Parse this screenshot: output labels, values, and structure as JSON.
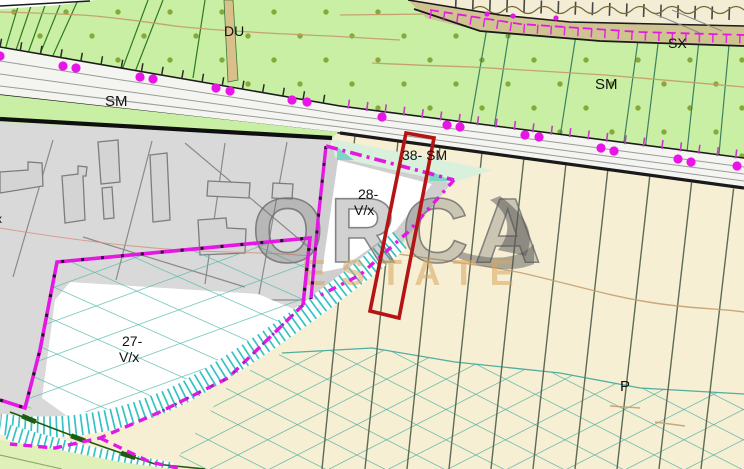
{
  "map": {
    "labels": {
      "du": "DU",
      "sx": "SX",
      "sm_upper": "SM",
      "sm_road": "SM",
      "parcel38": "38- SM",
      "parcel28_line1": "28-",
      "parcel28_line2": "V/x",
      "parcel27_line1": "27-",
      "parcel27_line2": "V/x",
      "p": "P",
      "edge_partial": "x"
    },
    "watermark": {
      "line1": "ORCA",
      "line2": "ESTATE"
    },
    "colors": {
      "orchard_green": "#c9efa4",
      "field_beige": "#f6efd4",
      "urban_gray": "#d9d9d9",
      "road_white": "#f4f4f1",
      "highlight_red": "#b41414",
      "boundary_magenta": "#e318e3",
      "slope_hatch_teal": "#35c2c2",
      "crosshatch_teal": "#52b1a5",
      "parcel_line_olive": "#5d6b55",
      "contour_tan": "#c49a6a",
      "orchard_dot_green": "#87a93c",
      "watermark_gray": "#6f6f6f",
      "watermark_gold": "#d9a75f"
    }
  }
}
